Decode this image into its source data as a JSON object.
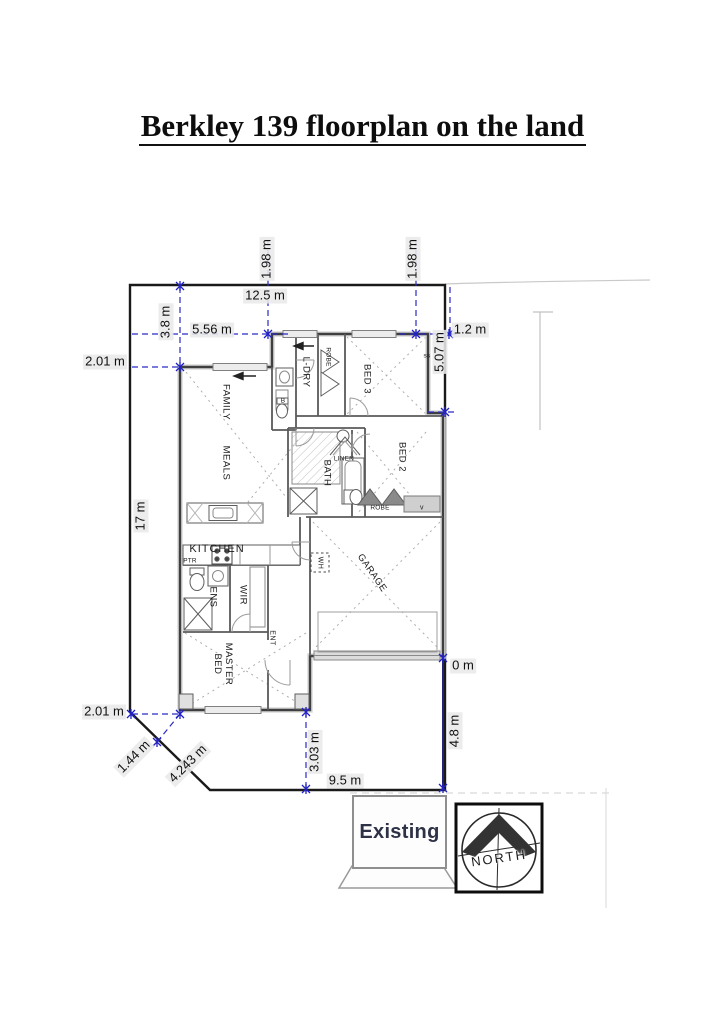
{
  "title": "Berkley 139 floorplan on the land",
  "colors": {
    "dimension_blue": "#2a2ac8",
    "boundary_black": "#1a1a1a",
    "existing_text": "#2e3246"
  },
  "dimensions": {
    "top_width": "12.5 m",
    "top_setback_left": "1.98 m",
    "top_setback_right": "1.98 m",
    "front_offset": "5.56 m",
    "left_offset_top": "3.8 m",
    "side_setback_upper": "2.01 m",
    "right_offset_top": "1.2 m",
    "right_side_upper": "5.07 m",
    "left_side": "17 m",
    "side_setback_lower": "2.01 m",
    "corner_splay_offset": "1.44 m",
    "corner_splay": "4.243 m",
    "rear_offset": "3.03 m",
    "rear_width": "9.5 m",
    "right_side_lower": "4.8 m",
    "garage_boundary_gap": "0 m"
  },
  "rooms": {
    "family": "FAMILY",
    "meals": "MEALS",
    "kitchen": "KITCHEN",
    "pantry": "PTR",
    "ensuite": "ENS",
    "wir": "WIR",
    "entry": "ENT",
    "master_bed": "MASTER BED",
    "garage": "GARAGE",
    "laundry": "L-DRY",
    "robe_bed3": "ROBE",
    "bed3": "BED 3",
    "bed2": "BED 2",
    "bath": "BATH",
    "linen": "LINEN",
    "robe_bed2": "ROBE",
    "water_heater": "WH",
    "vanity": "v",
    "smoke_sensor": "ss",
    "basin": "B"
  },
  "annotations": {
    "existing_label": "Existing",
    "north_label": "NORTH"
  }
}
